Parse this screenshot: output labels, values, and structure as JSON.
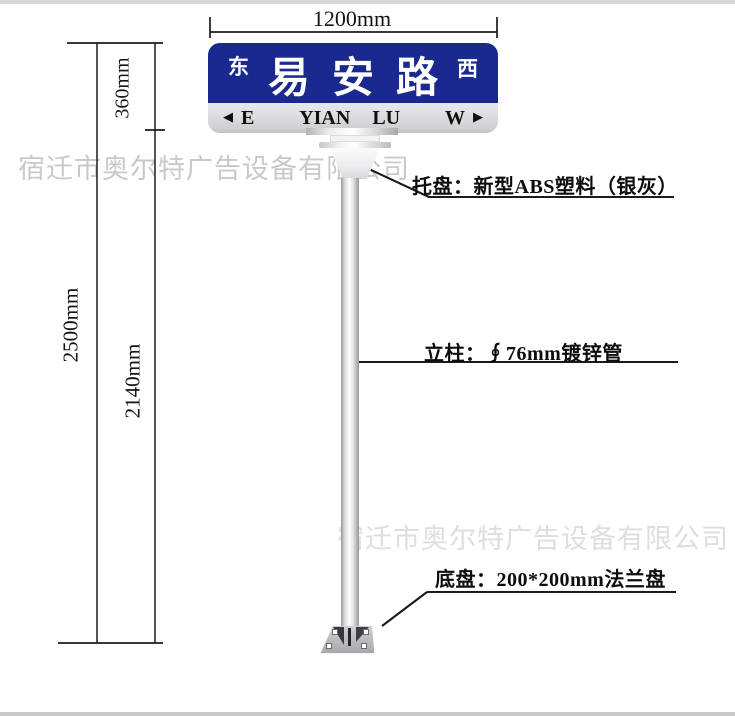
{
  "watermark": {
    "text": "宿迁市奥尔特广告设备有限公司"
  },
  "dimensions": {
    "width_top": "1200mm",
    "sign_height": "360mm",
    "total_height": "2500mm",
    "pole_height": "2140mm"
  },
  "sign": {
    "panel_color": "#19298f",
    "direction_left_cn": "东",
    "road_name_cn": "易安路",
    "direction_right_cn": "西",
    "arrow_left": "◀",
    "direction_left_en": "E",
    "road_name_en_word1": "YIAN",
    "road_name_en_word2": "LU",
    "direction_right_en": "W",
    "arrow_right": "▶"
  },
  "annotations": {
    "tray_label": "托盘：新型ABS塑料（银灰）",
    "pole_label": "立柱：∮76mm镀锌管",
    "base_label": "底盘：200*200mm法兰盘"
  }
}
